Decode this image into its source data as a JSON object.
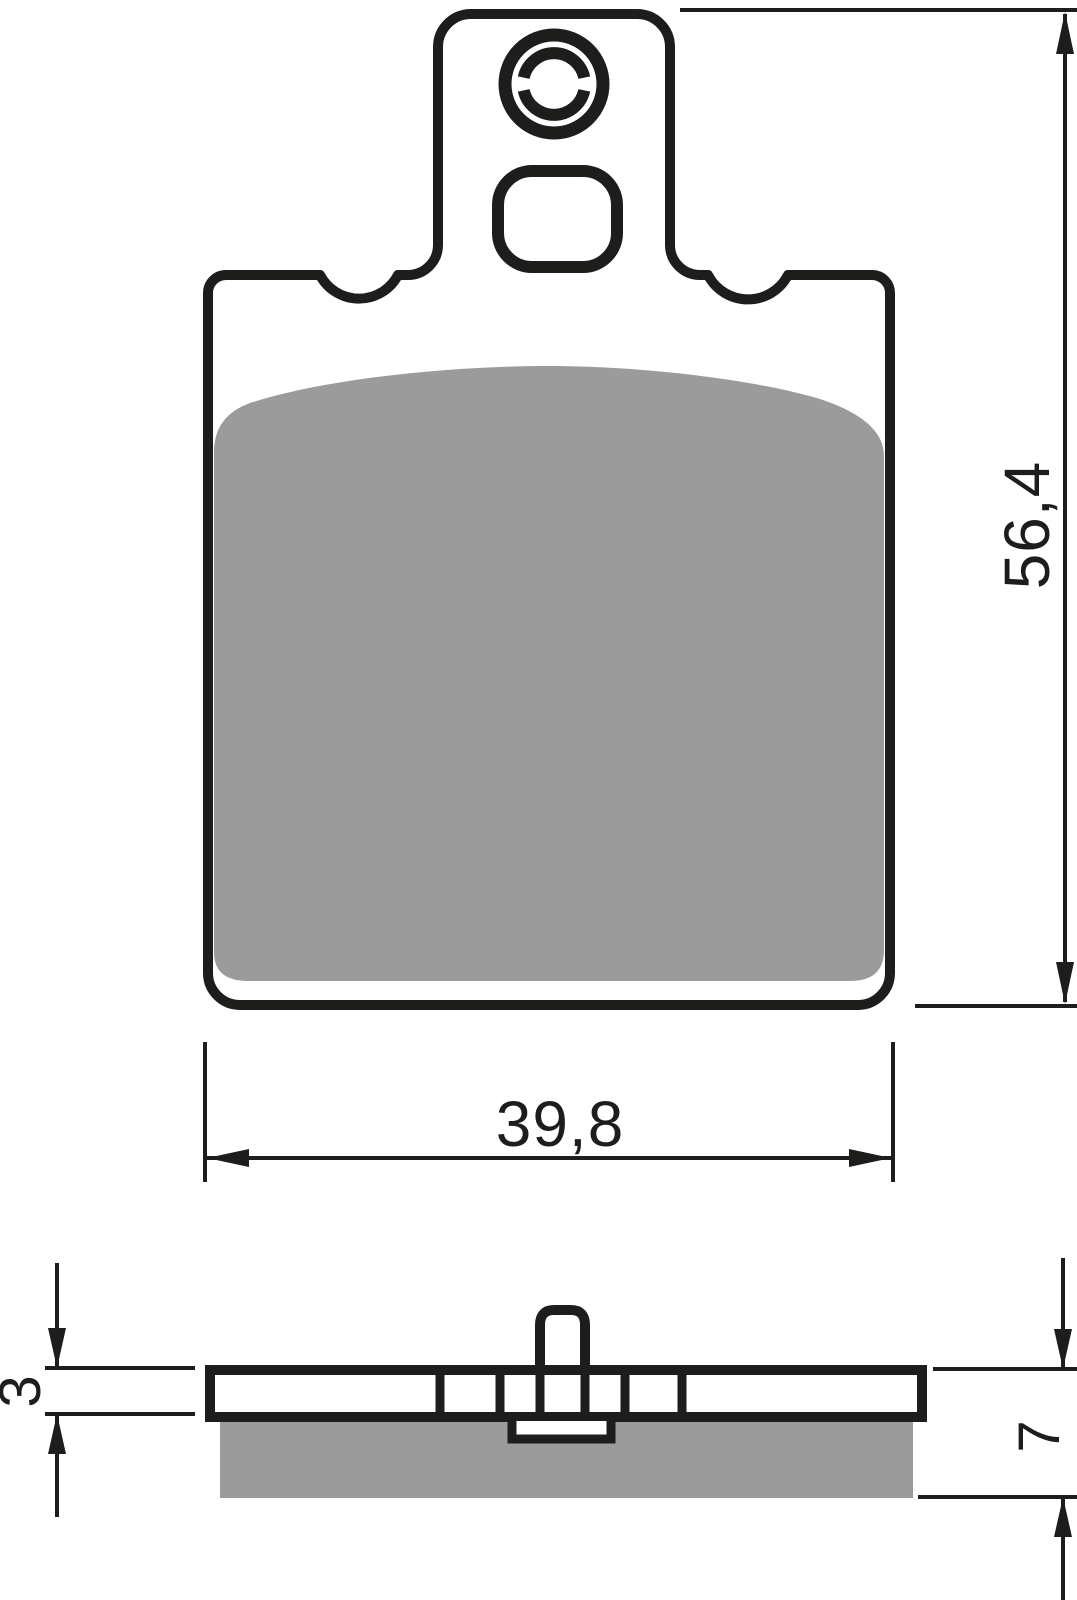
{
  "drawing": {
    "colors": {
      "line": "#1d1d1b",
      "friction": "#9b9b9b",
      "background": "#ffffff"
    },
    "dimensions": {
      "height": "56,4",
      "width": "39,8",
      "backplate_thickness": "3",
      "total_thickness": "7"
    }
  }
}
